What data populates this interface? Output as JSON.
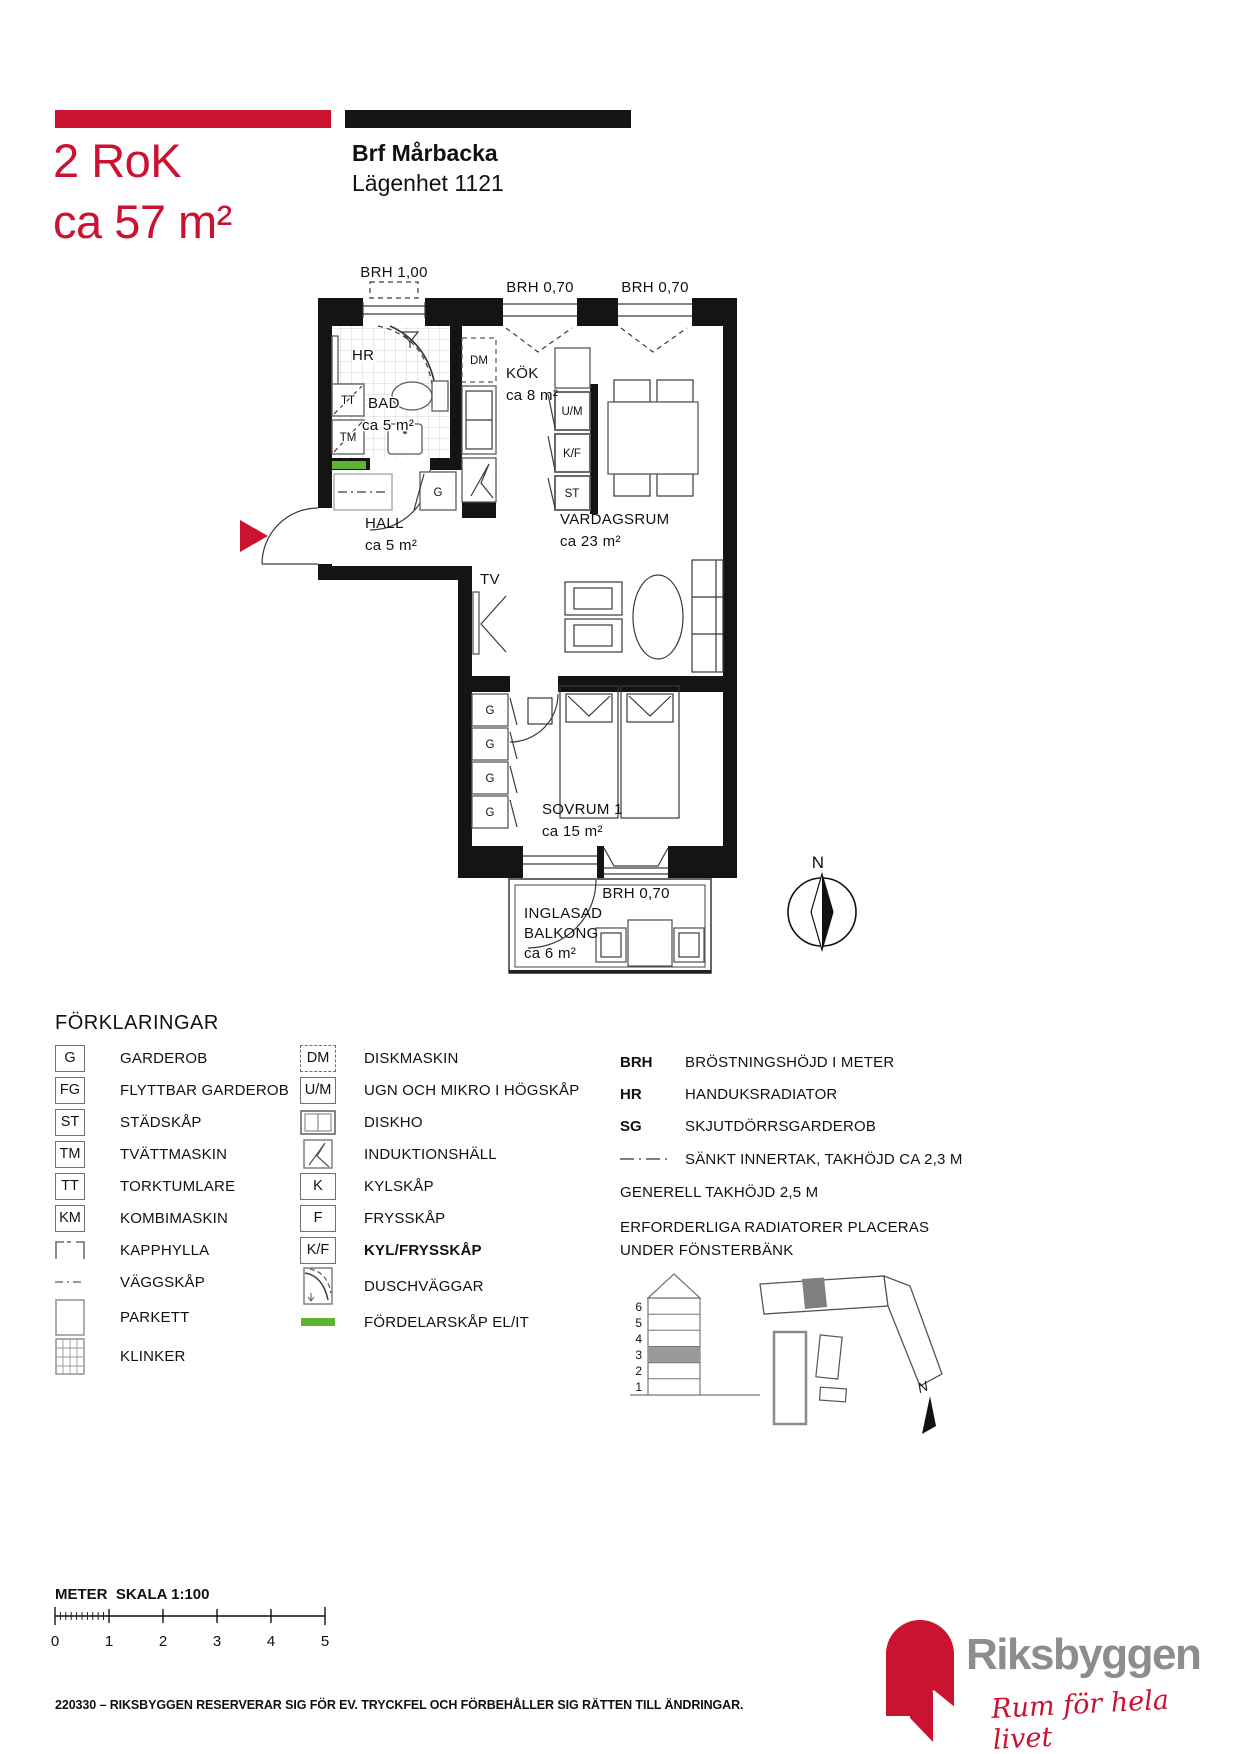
{
  "header": {
    "unit_type": "2 RoK",
    "unit_area": "ca 57 m²",
    "project": "Brf Mårbacka",
    "apartment": "Lägenhet 1121"
  },
  "colors": {
    "accent_red": "#cb1231",
    "wall_black": "#141414",
    "distribution_green": "#5cb531",
    "logo_gray": "#8d8d90",
    "highlight_gray": "#9a9a9a"
  },
  "floor_plan": {
    "window_labels": [
      "BRH 1,00",
      "BRH 0,70",
      "BRH 0,70",
      "BRH 0,70"
    ],
    "rooms": [
      {
        "name": "BAD",
        "area": "ca 5 m²"
      },
      {
        "name": "KÖK",
        "area": "ca 8 m²"
      },
      {
        "name": "HALL",
        "area": "ca 5 m²"
      },
      {
        "name": "VARDAGSRUM",
        "area": "ca 23 m²"
      },
      {
        "name": "SOVRUM 1",
        "area": "ca 15 m²"
      },
      {
        "name_line1": "INGLASAD",
        "name_line2": "BALKONG",
        "area": "ca 6 m²"
      }
    ],
    "fixtures": {
      "hr": "HR",
      "tt": "TT",
      "tm": "TM",
      "dm": "DM",
      "garderob": "G",
      "ugn_mikro": "U/M",
      "kyl_frys": "K/F",
      "stadskap": "ST",
      "tv": "TV"
    },
    "compass_label": "N"
  },
  "legend": {
    "title": "FÖRKLARINGAR",
    "col1": [
      {
        "symbol": "G",
        "label": "GARDEROB"
      },
      {
        "symbol": "FG",
        "label": "FLYTTBAR GARDEROB"
      },
      {
        "symbol": "ST",
        "label": "STÄDSKÅP"
      },
      {
        "symbol": "TM",
        "label": "TVÄTTMASKIN"
      },
      {
        "symbol": "TT",
        "label": "TORKTUMLARE"
      },
      {
        "symbol": "KM",
        "label": "KOMBIMASKIN"
      },
      {
        "icon": "kapphylla-icon",
        "label": "KAPPHYLLA"
      },
      {
        "icon": "vaggskap-icon",
        "label": "VÄGGSKÅP"
      },
      {
        "icon": "parkett-icon",
        "label": "PARKETT"
      },
      {
        "icon": "klinker-icon",
        "label": "KLINKER"
      }
    ],
    "col2": [
      {
        "symbol": "DM",
        "label": "DISKMASKIN"
      },
      {
        "symbol": "U/M",
        "label": "UGN OCH MIKRO I HÖGSKÅP"
      },
      {
        "icon": "diskho-icon",
        "label": "DISKHO"
      },
      {
        "icon": "induktionshall-icon",
        "label": "INDUKTIONSHÄLL"
      },
      {
        "symbol": "K",
        "label": "KYLSKÅP"
      },
      {
        "symbol": "F",
        "label": "FRYSSKÅP"
      },
      {
        "symbol": "K/F",
        "label": "KYL/FRYSSKÅP"
      },
      {
        "icon": "duschvaggar-icon",
        "label": "DUSCHVÄGGAR"
      },
      {
        "icon": "fordelarskap-icon",
        "label": "FÖRDELARSKÅP EL/IT"
      }
    ],
    "col3": [
      {
        "term": "BRH",
        "label": "BRÖSTNINGSHÖJD I METER"
      },
      {
        "term": "HR",
        "label": "HANDUKSRADIATOR"
      },
      {
        "term": "SG",
        "label": "SKJUTDÖRRSGARDEROB"
      },
      {
        "icon": "sankt-innertak-line",
        "label": "SÄNKT INNERTAK, TAKHÖJD CA 2,3 M"
      }
    ],
    "notes": [
      "GENERELL TAKHÖJD 2,5 M",
      "ERFORDERLIGA RADIATORER PLACERAS",
      "UNDER FÖNSTERBÄNK"
    ]
  },
  "position_diagrams": {
    "floor_numbers": [
      "6",
      "5",
      "4",
      "3",
      "2",
      "1"
    ],
    "highlighted_floor": "3",
    "north_label": "N"
  },
  "scale_bar": {
    "label": "METER  SKALA 1:100",
    "ticks": [
      "0",
      "1",
      "2",
      "3",
      "4",
      "5"
    ]
  },
  "footer": {
    "disclaimer": "220330 – RIKSBYGGEN RESERVERAR SIG FÖR EV. TRYCKFEL OCH FÖRBEHÅLLER SIG RÄTTEN TILL ÄNDRINGAR."
  },
  "logo": {
    "wordmark": "Riksbyggen",
    "tagline": "Rum för hela livet"
  }
}
